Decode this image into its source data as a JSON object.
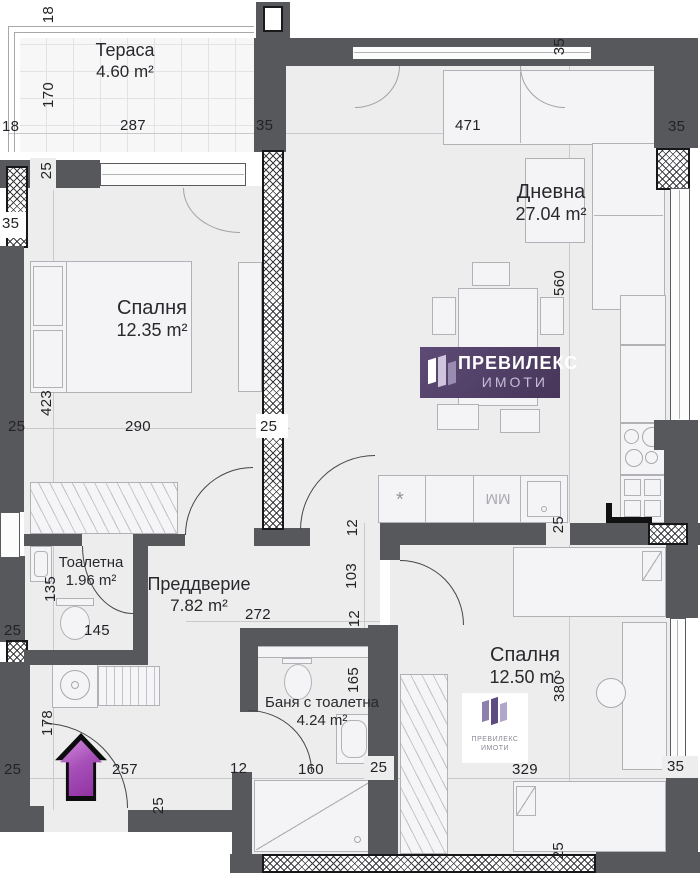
{
  "rooms": [
    {
      "name": "Тераса",
      "area": "4.60 m²"
    },
    {
      "name": "Дневна",
      "area": "27.04 m²"
    },
    {
      "name": "Спалня",
      "area": "12.35 m²"
    },
    {
      "name": "Преддверие",
      "area": "7.82 m²"
    },
    {
      "name": "Тоалетна",
      "area": "1.96 m²"
    },
    {
      "name": "Баня с тоалетна",
      "area": "4.24 m²"
    },
    {
      "name": "Спалня",
      "area": "12.50 m²"
    }
  ],
  "dims": [
    "18",
    "170",
    "287",
    "18",
    "35",
    "25",
    "471",
    "35",
    "35",
    "35",
    "423",
    "290",
    "25",
    "25",
    "560",
    "25",
    "12",
    "103",
    "12",
    "272",
    "145",
    "135",
    "25",
    "178",
    "257",
    "25",
    "25",
    "12",
    "165",
    "160",
    "25",
    "329",
    "35",
    "380",
    "25"
  ],
  "kitchen": {
    "dishwasher_mark": "*",
    "washer_mark": "ММ"
  },
  "logo": {
    "line1": "ПРЕВИЛЕКС",
    "line2": "ИМОТИ"
  },
  "watermark": {
    "line1": "ПРЕВИЛЕКС",
    "line2": "ИМОТИ"
  },
  "colors": {
    "wall": "#57585c",
    "floor": "#ededee",
    "brand_purple": "#4d3c63",
    "arrow_purple": "#a750b8"
  }
}
